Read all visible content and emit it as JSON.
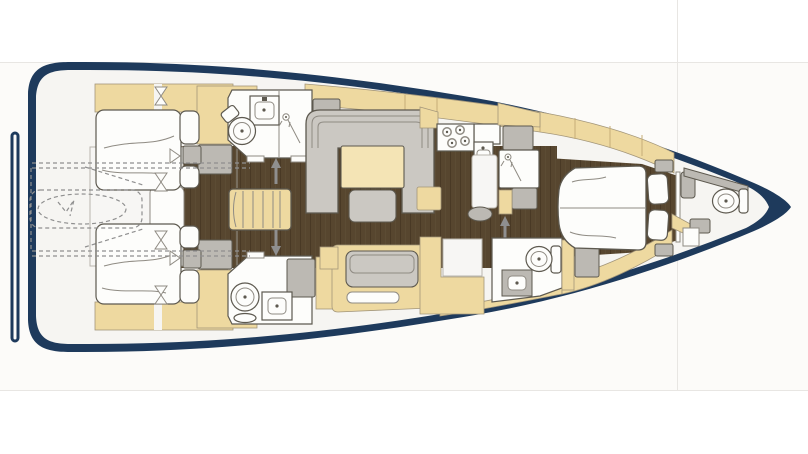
{
  "page": {
    "width": 808,
    "height": 454,
    "background": "#ffffff"
  },
  "colors": {
    "hull": "#1e3a5c",
    "deck": "#f6f5f2",
    "wood": "#57462f",
    "wood_dark": "#493925",
    "wood_light": "#64523a",
    "tan": "#eed9a0",
    "tan_line": "#c6ad77",
    "tan_edge": "#a3967a",
    "gray": "#cbc8c2",
    "gray_dark": "#bcb9b3",
    "fixture": "#fdfdfb",
    "table": "#f4e4b5",
    "outline": "#5d594f",
    "outline_soft": "#8f8b83",
    "dash": "#8f8f8f",
    "frame": "#e8e6e3",
    "photo_bg": "#fcfbf9",
    "white_strip": "#f7f6f4",
    "strip_edge": "#b9b5ae"
  },
  "diagram": {
    "type": "yacht-interior-floorplan",
    "orientation": "bow-right-stern-left",
    "rooms": [
      {
        "name": "swim-platform"
      },
      {
        "name": "tender-garage",
        "style": "dashed-optional"
      },
      {
        "name": "aft-cabin-starboard"
      },
      {
        "name": "aft-cabin-port"
      },
      {
        "name": "aft-head-starboard"
      },
      {
        "name": "aft-head-port"
      },
      {
        "name": "companionway"
      },
      {
        "name": "saloon"
      },
      {
        "name": "galley"
      },
      {
        "name": "nav-station"
      },
      {
        "name": "forward-shower-room"
      },
      {
        "name": "forward-wc-room"
      },
      {
        "name": "owner-cabin-forward"
      },
      {
        "name": "bow-compartment"
      }
    ],
    "fixtures": [
      "double-berth",
      "pillows",
      "wardrobe",
      "stairs",
      "toilet",
      "washbasin",
      "shower-head",
      "stove-burners",
      "u-sofa",
      "saloon-table",
      "ottoman",
      "settee",
      "island-berth",
      "dinghy-outline",
      "door-swing-marker",
      "entry-arrow"
    ]
  }
}
